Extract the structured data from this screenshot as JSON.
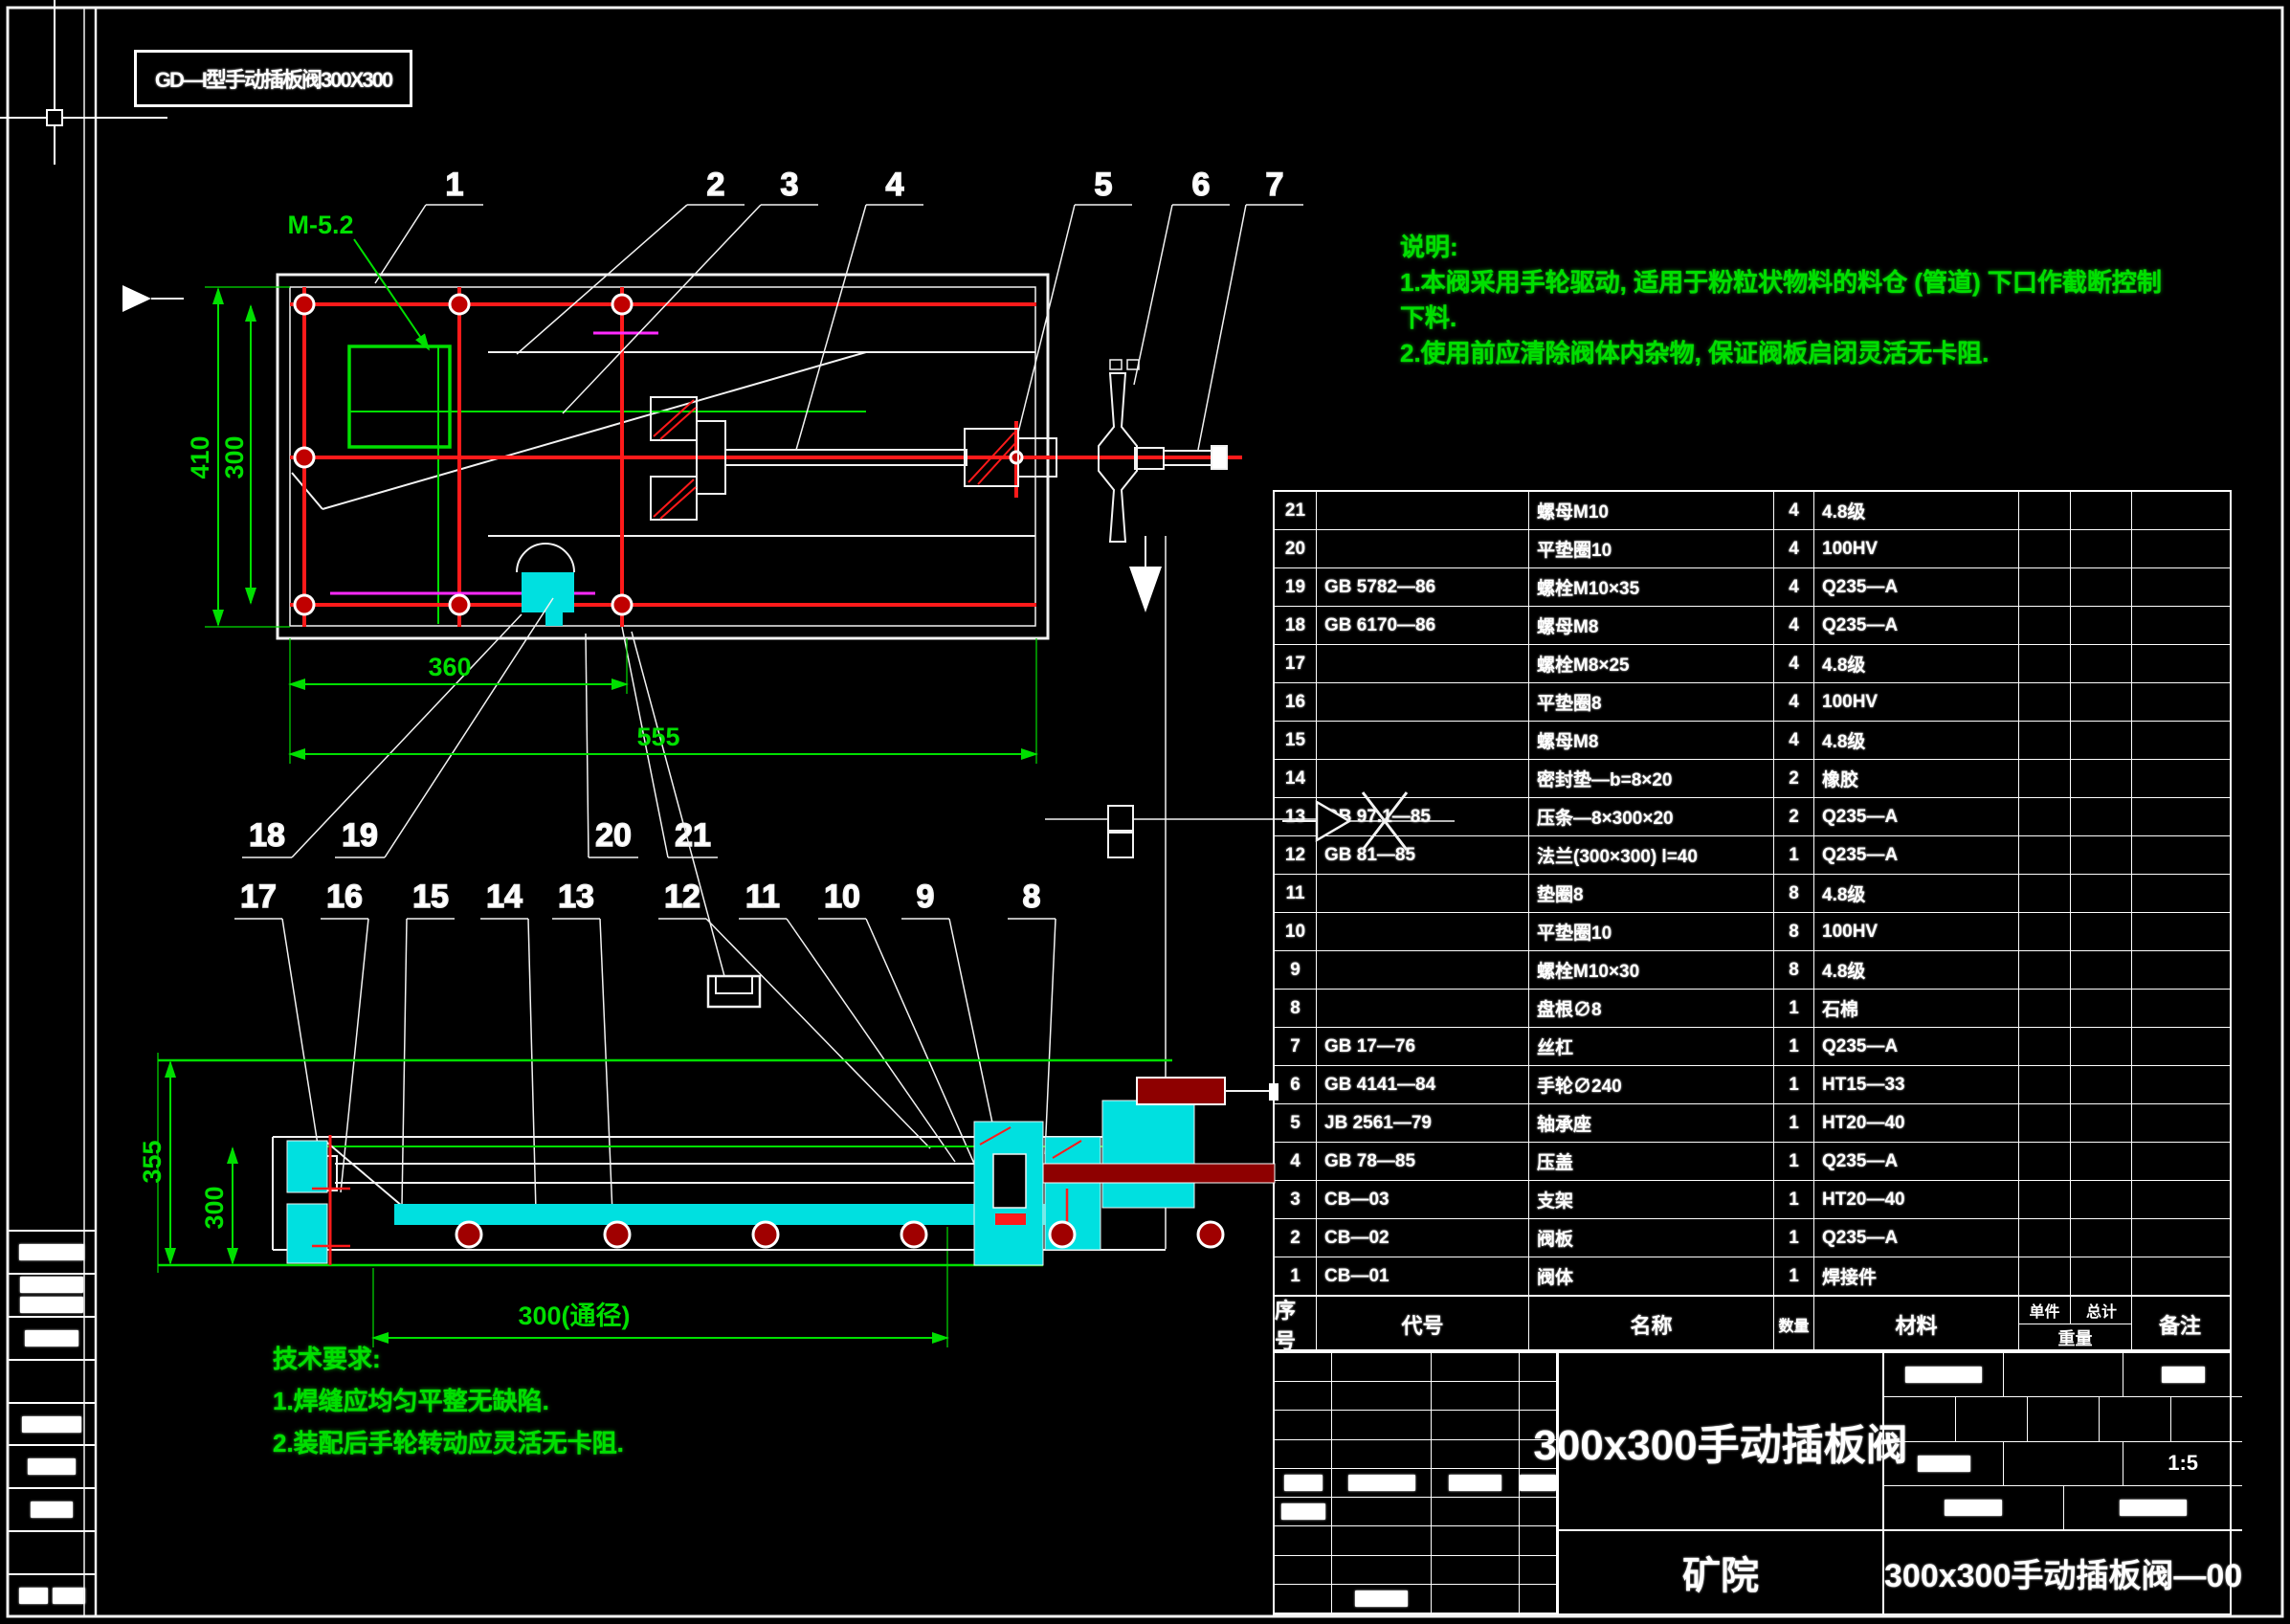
{
  "header": {
    "label": "GD—I型手动插板阀300X300"
  },
  "notes_top": {
    "heading": "说明:",
    "line1": "1.本阀采用手轮驱动, 适用于粉粒状物料的料仓 (管道) 下口作截断控制",
    "line2": "下料.",
    "line3": "2.使用前应清除阀体内杂物, 保证阀板启闭灵活无卡阻."
  },
  "notes_bottom": {
    "heading": "技术要求:",
    "line1": "1.焊缝应均匀平整无缺陷.",
    "line2": "2.装配后手轮转动应灵活无卡阻."
  },
  "balloons": {
    "top": [
      "1",
      "2",
      "3",
      "4",
      "5",
      "6",
      "7"
    ],
    "low": [
      "18",
      "19",
      "20",
      "21"
    ],
    "mid": [
      "17",
      "16",
      "15",
      "14",
      "13",
      "12",
      "11",
      "10",
      "9",
      "8"
    ]
  },
  "dims": {
    "top": {
      "left_outer": "410",
      "left_inner": "300",
      "bottom_inner": "360",
      "bottom_overall": "555",
      "weld_note": "M-5.2"
    },
    "section": {
      "left_outer": "355",
      "left_inner": "300",
      "bottom": "300(通径)"
    }
  },
  "bom": {
    "headers": {
      "no": "序号",
      "code": "代号",
      "name": "名称",
      "qty": "数量",
      "mat": "材料",
      "unit": "单件",
      "total": "总计",
      "weight": "重量",
      "remark": "备注"
    },
    "rows": [
      {
        "no": "21",
        "code": "",
        "name": "螺母M10",
        "qty": "4",
        "mat": "4.8级"
      },
      {
        "no": "20",
        "code": "",
        "name": "平垫圈10",
        "qty": "4",
        "mat": "100HV"
      },
      {
        "no": "19",
        "code": "GB 5782—86",
        "name": "螺栓M10×35",
        "qty": "4",
        "mat": "Q235—A"
      },
      {
        "no": "18",
        "code": "GB 6170—86",
        "name": "螺母M8",
        "qty": "4",
        "mat": "Q235—A"
      },
      {
        "no": "17",
        "code": "",
        "name": "螺栓M8×25",
        "qty": "4",
        "mat": "4.8级"
      },
      {
        "no": "16",
        "code": "",
        "name": "平垫圈8",
        "qty": "4",
        "mat": "100HV"
      },
      {
        "no": "15",
        "code": "",
        "name": "螺母M8",
        "qty": "4",
        "mat": "4.8级"
      },
      {
        "no": "14",
        "code": "",
        "name": "密封垫—b=8×20",
        "qty": "2",
        "mat": "橡胶"
      },
      {
        "no": "13",
        "code": "GB 97.1—85",
        "name": "压条—8×300×20",
        "qty": "2",
        "mat": "Q235—A"
      },
      {
        "no": "12",
        "code": "GB 81—85",
        "name": "法兰(300×300) l=40",
        "qty": "1",
        "mat": "Q235—A"
      },
      {
        "no": "11",
        "code": "",
        "name": "垫圈8",
        "qty": "8",
        "mat": "4.8级"
      },
      {
        "no": "10",
        "code": "",
        "name": "平垫圈10",
        "qty": "8",
        "mat": "100HV"
      },
      {
        "no": "9",
        "code": "",
        "name": "螺栓M10×30",
        "qty": "8",
        "mat": "4.8级"
      },
      {
        "no": "8",
        "code": "",
        "name": "盘根∅8",
        "qty": "1",
        "mat": "石棉"
      },
      {
        "no": "7",
        "code": "GB 17—76",
        "name": "丝杠",
        "qty": "1",
        "mat": "Q235—A"
      },
      {
        "no": "6",
        "code": "GB 4141—84",
        "name": "手轮∅240",
        "qty": "1",
        "mat": "HT15—33"
      },
      {
        "no": "5",
        "code": "JB 2561—79",
        "name": "轴承座",
        "qty": "1",
        "mat": "HT20—40"
      },
      {
        "no": "4",
        "code": "GB 78—85",
        "name": "压盖",
        "qty": "1",
        "mat": "Q235—A"
      },
      {
        "no": "3",
        "code": "CB—03",
        "name": "支架",
        "qty": "1",
        "mat": "HT20—40"
      },
      {
        "no": "2",
        "code": "CB—02",
        "name": "阀板",
        "qty": "1",
        "mat": "Q235—A"
      },
      {
        "no": "1",
        "code": "CB—01",
        "name": "阀体",
        "qty": "1",
        "mat": "焊接件"
      }
    ]
  },
  "title_block": {
    "title": "300x300手动插板阀",
    "org": "矿院",
    "scale": "1:5",
    "drawing_no": "300x300手动插板阀—00"
  },
  "colors": {
    "green": "#00df00",
    "red": "#ff1a1a",
    "dark_red": "#8e0000",
    "cyan": "#00e0e0",
    "magenta": "#ff2aff",
    "white": "#ffffff"
  }
}
